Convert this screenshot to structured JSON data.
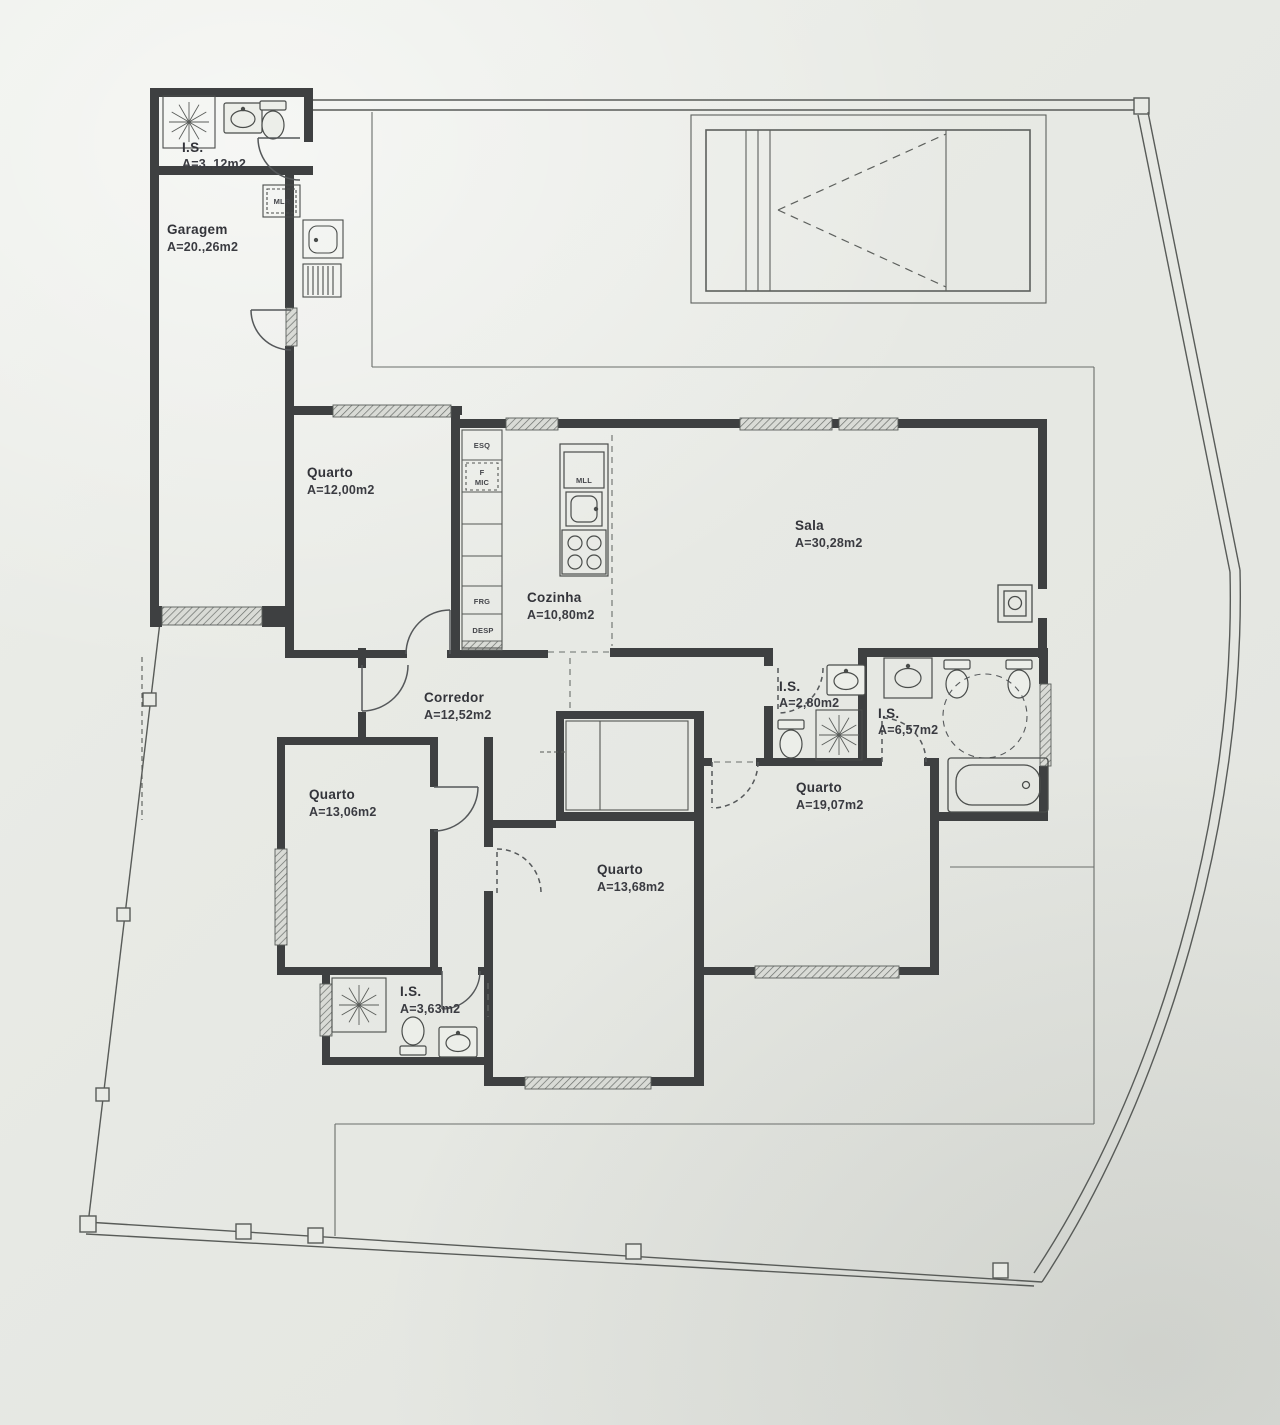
{
  "plan": {
    "rooms": [
      {
        "id": "is-top",
        "name": "I.S.",
        "area": "A=3.,12m2"
      },
      {
        "id": "garagem",
        "name": "Garagem",
        "area": "A=20.,26m2"
      },
      {
        "id": "quarto-nw",
        "name": "Quarto",
        "area": "A=12,00m2"
      },
      {
        "id": "cozinha",
        "name": "Cozinha",
        "area": "A=10,80m2"
      },
      {
        "id": "sala",
        "name": "Sala",
        "area": "A=30,28m2"
      },
      {
        "id": "corredor",
        "name": "Corredor",
        "area": "A=12,52m2"
      },
      {
        "id": "is-small",
        "name": "I.S.",
        "area": "A=2,80m2"
      },
      {
        "id": "is-suite",
        "name": "I.S.",
        "area": "A=6,57m2"
      },
      {
        "id": "quarto-e",
        "name": "Quarto",
        "area": "A=19,07m2"
      },
      {
        "id": "quarto-sw",
        "name": "Quarto",
        "area": "A=13,06m2"
      },
      {
        "id": "quarto-s",
        "name": "Quarto",
        "area": "A=13,68m2"
      },
      {
        "id": "is-sw",
        "name": "I.S.",
        "area": "A=3,63m2"
      }
    ],
    "appliances": {
      "mlr": "MLR",
      "esq": "ESQ",
      "f": "F",
      "mic": "MIC",
      "frg": "FRG",
      "desp": "DESP",
      "mll": "MLL"
    },
    "palette": {
      "paper": "#e8eae5",
      "wall": "#3e4041",
      "thin_line": "#616562",
      "text": "#33343a",
      "hatch_fill": "#d9dbd6"
    }
  }
}
